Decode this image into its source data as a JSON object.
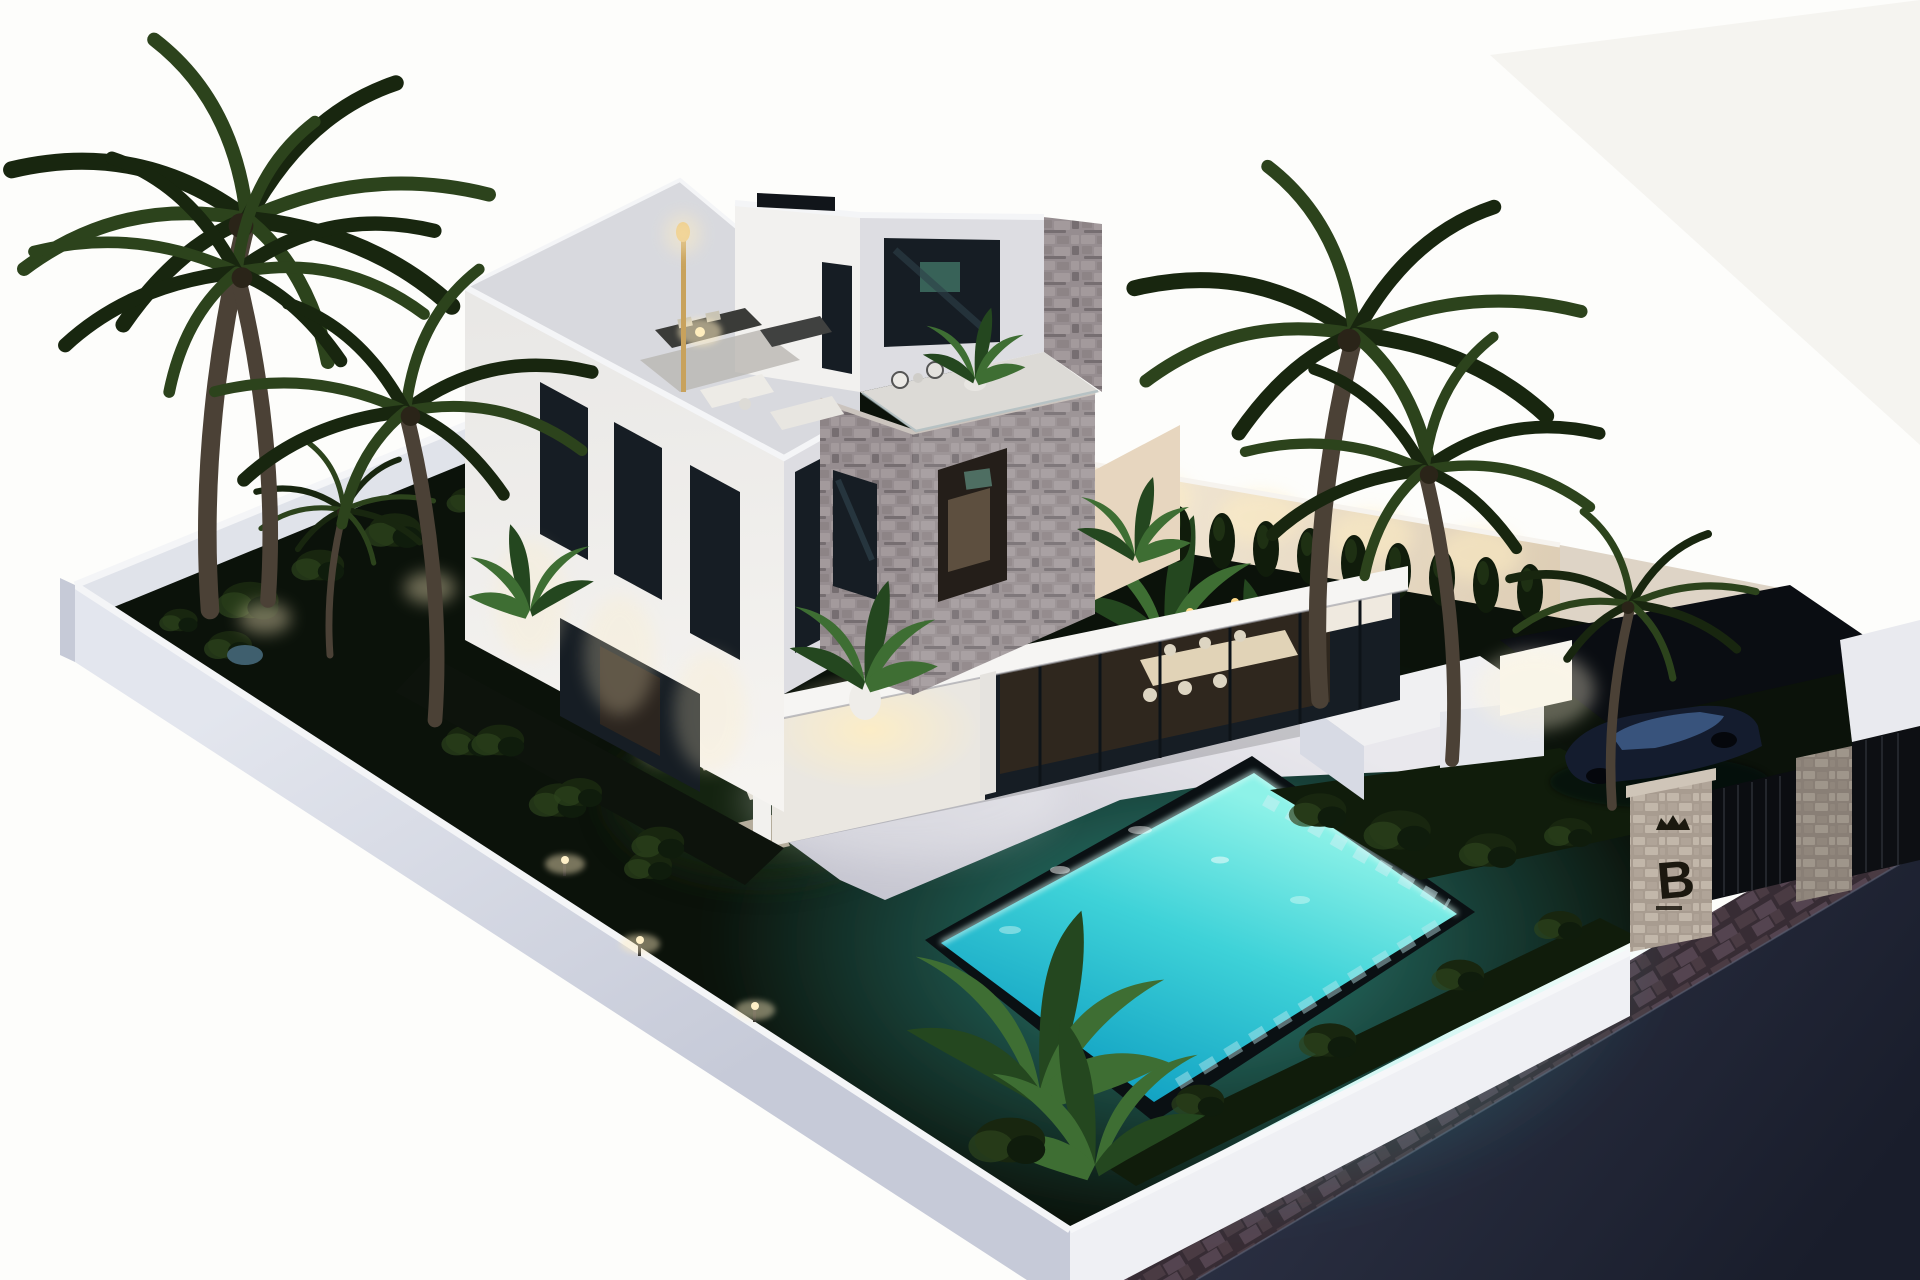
{
  "scene": {
    "type": "3d-architectural-render",
    "view": "aerial night-time exterior visualization",
    "description": "Aerial night render of a modern white villa with a stone-clad tower, rooftop terraces with lounge furniture, an illuminated turquoise swimming pool, dark lawn with garden lights, palm trees, a carport with a dark car, and a stone entrance pillar marked with a crowned letter B beside a paved street.",
    "entrance_sign": {
      "letter": "B"
    }
  },
  "colors": {
    "bg": "#fdfdfb",
    "bg_tint": "#f5f4f0",
    "wall_top": "#f4f5f7",
    "wall_face": "#d7dae4",
    "wall_face_dark": "#c6cad7",
    "wall_inner": "#e0e3ea",
    "lawn": "#0b120a",
    "lawn_lit": "#1f3015",
    "patio": "#cdcdd6",
    "patio_bright": "#ebeaef",
    "pool_bright": "#8df2e8",
    "pool_mid": "#3ed2d8",
    "pool_deep": "#0f9fc2",
    "pool_glow": "#45e2d8",
    "rim_dark": "#0a1013",
    "house_lit": "#f2f1ef",
    "house_shade": "#dddde2",
    "house_dark": "#c3c4cc",
    "slab": "#f6f5f3",
    "stone_1": "#a39a9c",
    "stone_2": "#8d8486",
    "stone_3": "#968d90",
    "stone_4": "#766e71",
    "pillar_1": "#c2b7aa",
    "pillar_2": "#b0a498",
    "pillar_3": "#a89c90",
    "glass": "#161d24",
    "glass_refl": "#2e4049",
    "interior_warm": "#32281e",
    "interior_glow": "#f5e7c8",
    "warm_light": "#ffeec2",
    "palm_dark": "#18260f",
    "palm_mid": "#2c431c",
    "leaf": "#3e6e33",
    "leaf_dark": "#24471f",
    "trunk": "#4b4136",
    "street_a": "#2e3347",
    "street_b": "#191d2b",
    "paver_1": "#4a3b43",
    "paver_2": "#544450",
    "paver_3": "#372c34",
    "hedge": "#101c0b",
    "car_body": "#141c2e",
    "car_roof": "#3c5a85",
    "car_shadow": "#05070c",
    "gold": "#c8a25c",
    "sign": "#1b180f"
  }
}
